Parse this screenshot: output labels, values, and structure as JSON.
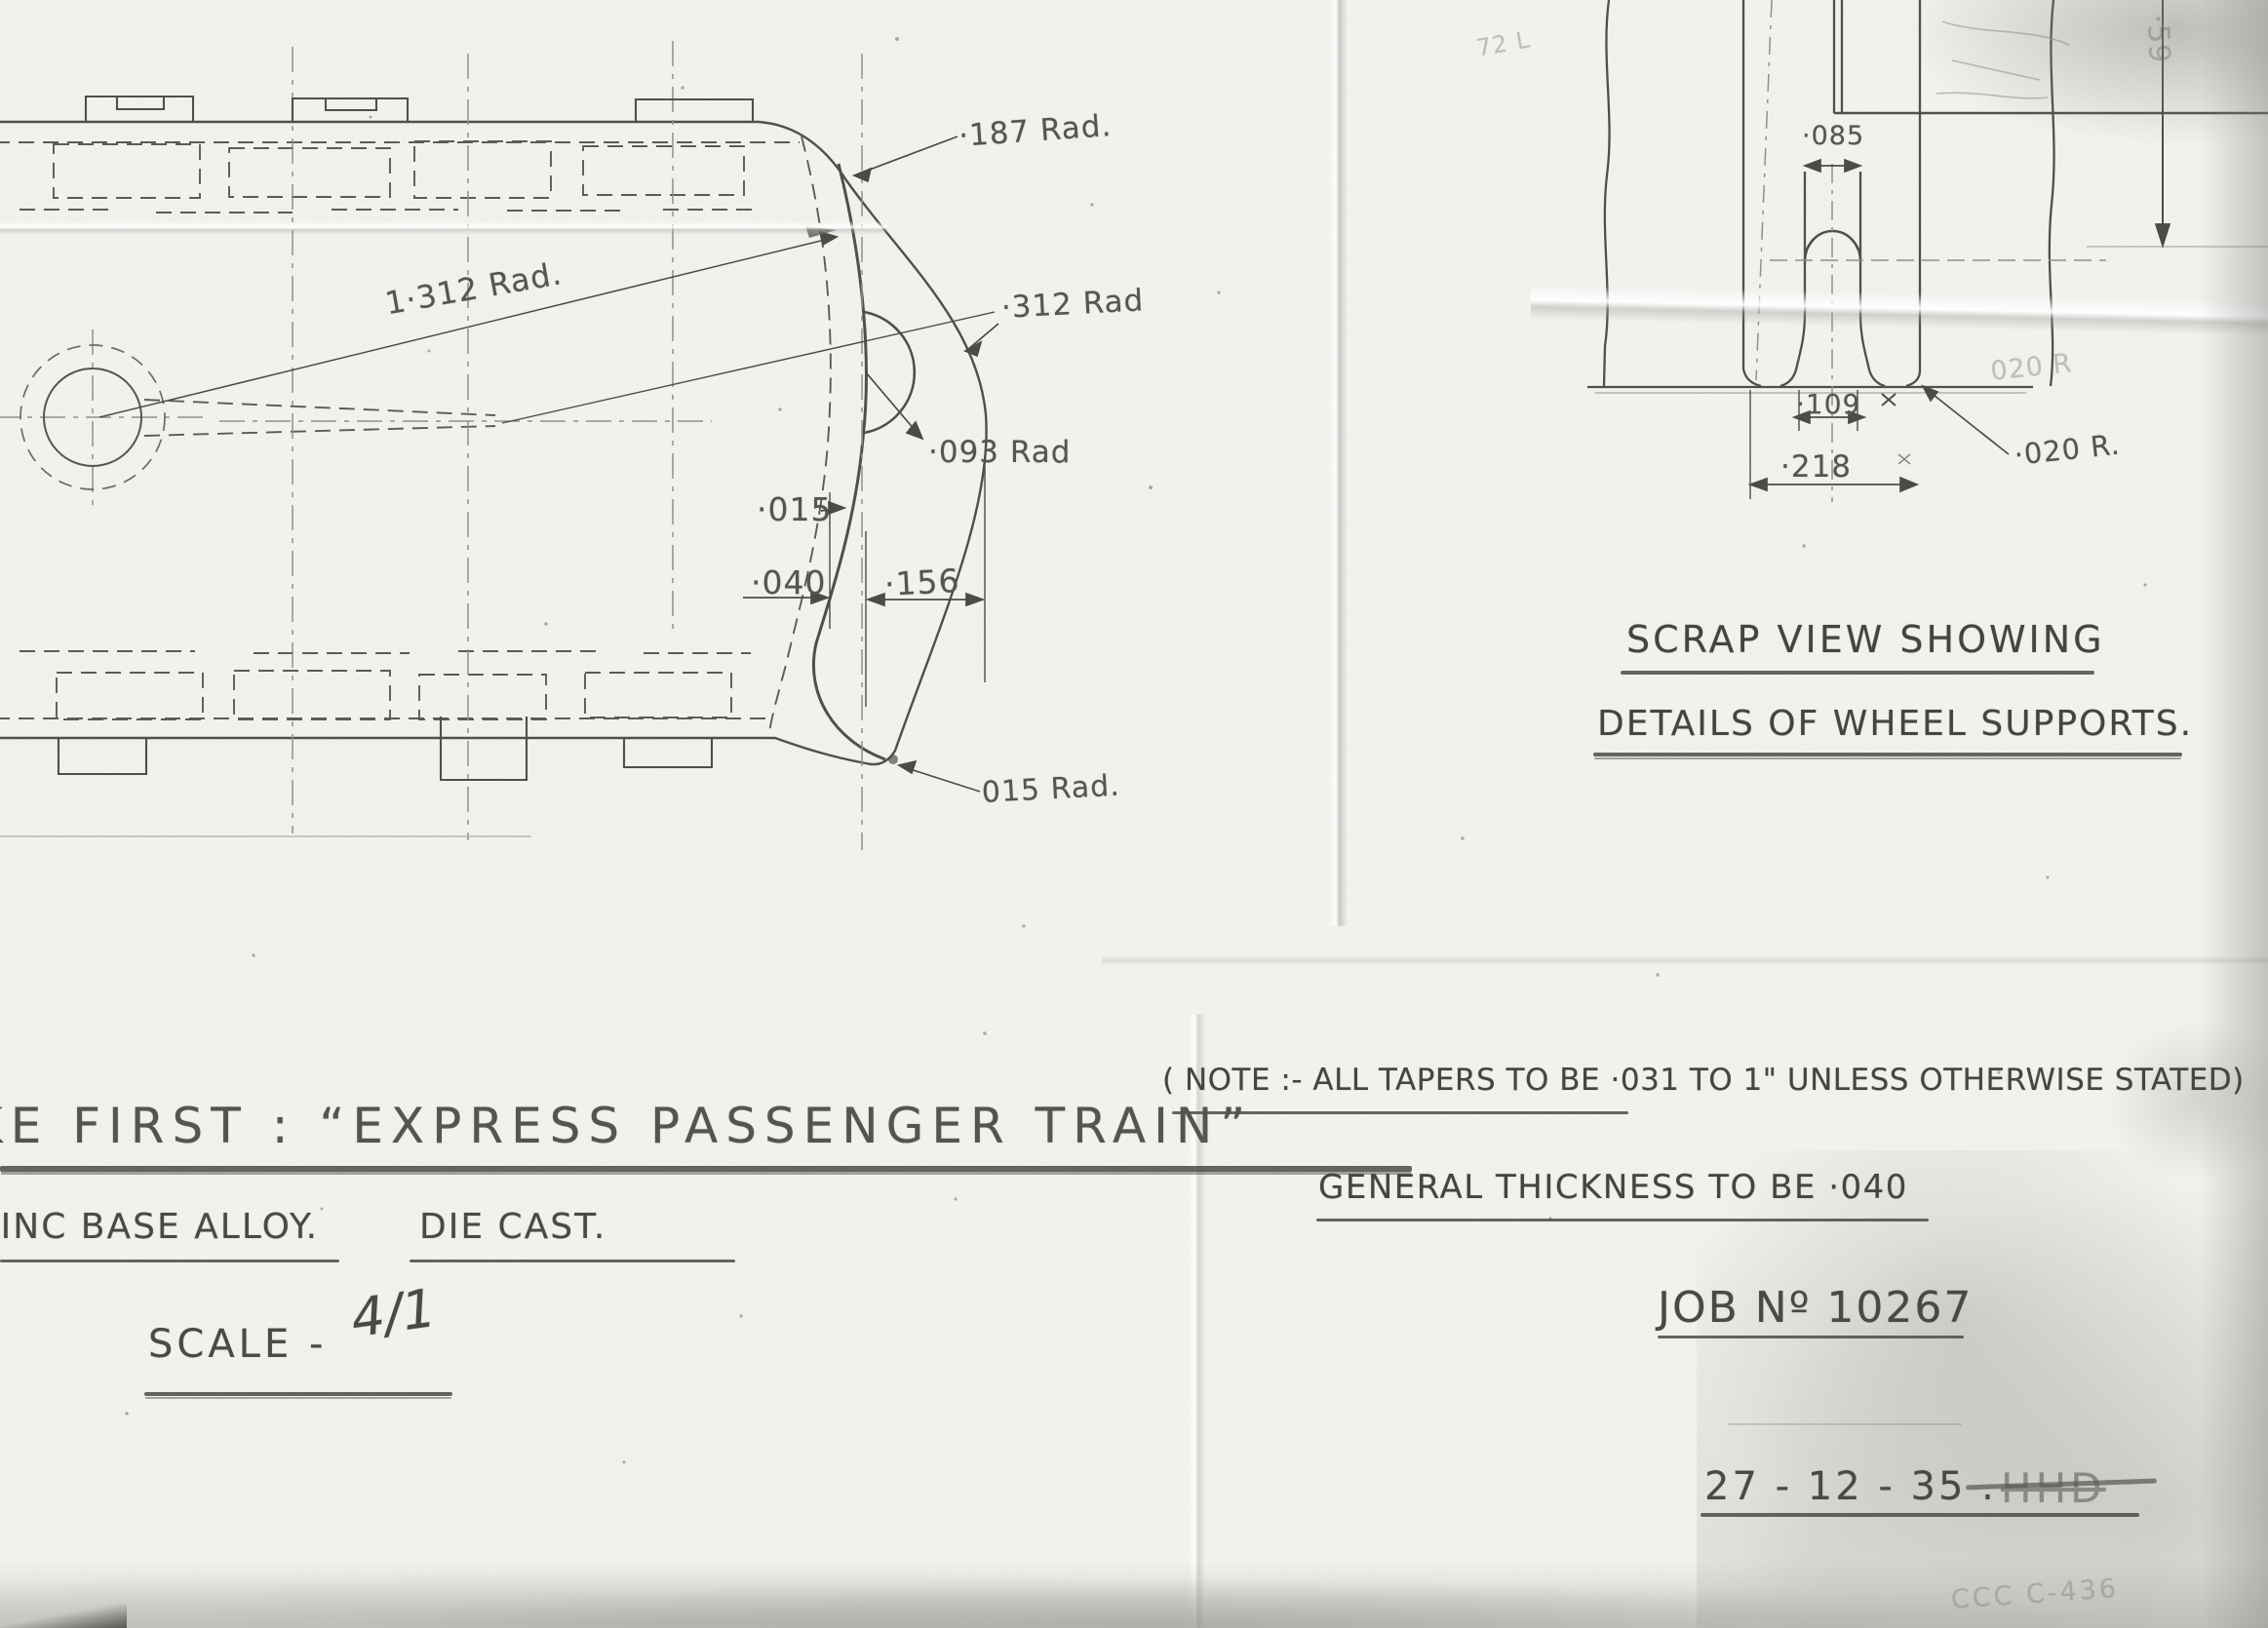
{
  "sheet": {
    "left_view": {
      "rad_187": "·187 Rad.",
      "rad_1312": "1·312 Rad.",
      "rad_312": "·312 Rad",
      "rad_093": "·093 Rad",
      "dim_015": "·015",
      "dim_040": "·040",
      "dim_156": "·156",
      "rad_015": "015 Rad."
    },
    "scrap_view": {
      "dim_085": "·085",
      "dim_109": "·109",
      "dim_218": "·218",
      "rad_020": "·020 R.",
      "ghost_020": "020 R",
      "ghost_59": "·59",
      "caption_line1": "SCRAP VIEW SHOWING",
      "caption_line2": "DETAILS OF WHEEL SUPPORTS."
    },
    "notes": {
      "line1": "( NOTE :- ALL TAPERS TO BE ·031 TO 1\" UNLESS OTHERWISE STATED)",
      "line2": "GENERAL THICKNESS TO BE ·040"
    },
    "title_block": {
      "title": "KE FIRST : “EXPRESS PASSENGER TRAIN”",
      "material": "ZINC BASE ALLOY.",
      "process": "DIE CAST.",
      "scale_label": "SCALE -",
      "scale_value": "4/1",
      "job_number": "JOB Nº 10267",
      "date": "27 - 12 - 35 .",
      "crossed_out_initials": "HHD",
      "faint_stamp": "CCC C-436",
      "ghost_mark": "72 L"
    }
  }
}
